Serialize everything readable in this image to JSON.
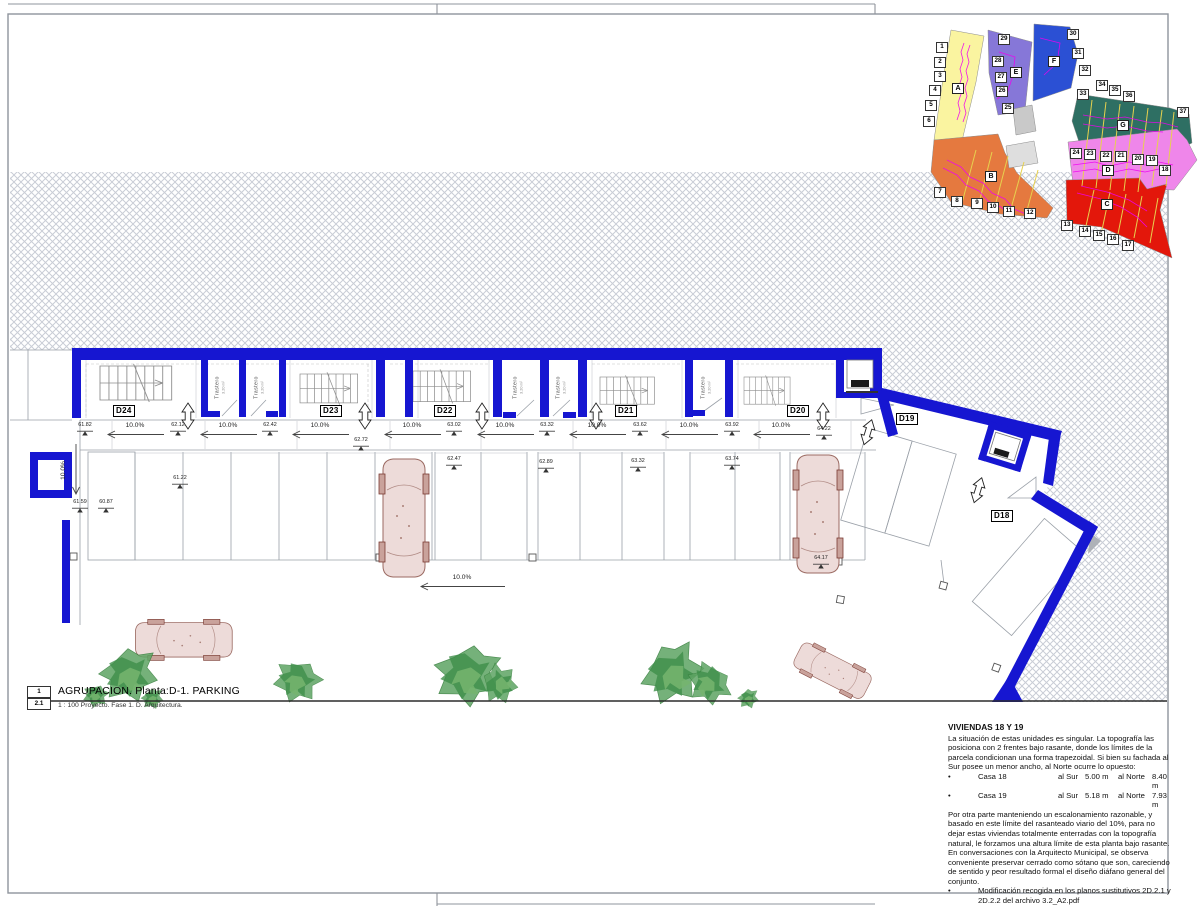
{
  "colors": {
    "wall_blue": "#1616d1",
    "hatch_gray": "#c9cdd6"
  },
  "title_block": {
    "sheet_no": "1",
    "detail_no": "2.1",
    "title": "AGRUPACION. Planta:D-1. PARKING",
    "scale_line": "1 : 100 Proyecto. Fase 1. D. Arquitectura."
  },
  "notes": {
    "title": "VIVIENDAS 18 Y 19",
    "bullet_char": "•",
    "para1": "La situación de estas unidades es singular. La topografía las posiciona con 2 frentes bajo rasante, donde los límites de la parcela condicionan una forma trapezoidal. Si bien su fachada al Sur posee un menor ancho, al Norte ocurre lo opuesto:",
    "bullets": [
      {
        "name": "Casa 18",
        "sur_label": "al Sur",
        "sur": "5.00 m",
        "norte_label": "al Norte",
        "norte": "8.40 m"
      },
      {
        "name": "Casa 19",
        "sur_label": "al Sur",
        "sur": "5.18 m",
        "norte_label": "al Norte",
        "norte": "7.93 m"
      }
    ],
    "para2": "Por otra parte manteniendo un escalonamiento razonable, y basado en este límite del rasanteado viario del 10%, para no dejar estas viviendas totalmente enterradas con la topografía natural, le forzamos una altura límite de esta planta bajo rasante. En conversaciones con la Arquitecto Municipal, se observa conveniente preservar cerrado como sótano que son, careciendo de sentido y peor resultado formal el diseño diáfano general del conjunto.",
    "bullet2_line1": "Modificación recogida en los planos sustitutivos 2D.2.1 y",
    "bullet2_line2": "2D.2.2 del archivo 3.2_A2.pdf"
  },
  "plan": {
    "slope_text": "10.0%",
    "trastero_label": "Trastero",
    "trastero_area": "3.20 m²",
    "units": [
      {
        "id": "D24",
        "x": 126,
        "y": 412
      },
      {
        "id": "D23",
        "x": 333,
        "y": 412
      },
      {
        "id": "D22",
        "x": 447,
        "y": 412
      },
      {
        "id": "D21",
        "x": 628,
        "y": 412
      },
      {
        "id": "D20",
        "x": 800,
        "y": 412
      },
      {
        "id": "D19",
        "x": 909,
        "y": 420
      },
      {
        "id": "D18",
        "x": 1004,
        "y": 517
      }
    ],
    "aisle_elevations": [
      {
        "v": "61.82",
        "x": 88,
        "y": 429
      },
      {
        "v": "62.12",
        "x": 181,
        "y": 429
      },
      {
        "v": "62.42",
        "x": 273,
        "y": 429
      },
      {
        "v": "62.72",
        "x": 364,
        "y": 444
      },
      {
        "v": "63.02",
        "x": 457,
        "y": 429
      },
      {
        "v": "63.32",
        "x": 550,
        "y": 429
      },
      {
        "v": "63.62",
        "x": 643,
        "y": 429
      },
      {
        "v": "63.92",
        "x": 735,
        "y": 429
      },
      {
        "v": "64.22",
        "x": 827,
        "y": 433
      }
    ],
    "bay_elevations": [
      {
        "v": "61.59",
        "x": 83,
        "y": 506
      },
      {
        "v": "60.87",
        "x": 109,
        "y": 506
      },
      {
        "v": "61.22",
        "x": 183,
        "y": 482
      },
      {
        "v": "62.47",
        "x": 457,
        "y": 463
      },
      {
        "v": "62.89",
        "x": 549,
        "y": 466
      },
      {
        "v": "63.32",
        "x": 641,
        "y": 465
      },
      {
        "v": "63.74",
        "x": 735,
        "y": 463
      },
      {
        "v": "64.17",
        "x": 824,
        "y": 562
      }
    ],
    "slope_arrows": [
      {
        "x": 135,
        "y": 426,
        "dir": "left",
        "len": 58
      },
      {
        "x": 228,
        "y": 426,
        "dir": "left",
        "len": 58
      },
      {
        "x": 320,
        "y": 426,
        "dir": "left",
        "len": 58
      },
      {
        "x": 412,
        "y": 426,
        "dir": "left",
        "len": 58
      },
      {
        "x": 505,
        "y": 426,
        "dir": "left",
        "len": 58
      },
      {
        "x": 597,
        "y": 426,
        "dir": "left",
        "len": 58
      },
      {
        "x": 689,
        "y": 426,
        "dir": "left",
        "len": 58
      },
      {
        "x": 781,
        "y": 426,
        "dir": "left",
        "len": 58
      },
      {
        "x": 462,
        "y": 578,
        "dir": "left",
        "len": 86
      },
      {
        "x": 72,
        "y": 470,
        "dir": "down",
        "len": 52
      }
    ],
    "trasteros": [
      {
        "x": 222,
        "y": 381
      },
      {
        "x": 261,
        "y": 381
      },
      {
        "x": 520,
        "y": 381
      },
      {
        "x": 563,
        "y": 381
      },
      {
        "x": 708,
        "y": 381
      }
    ]
  },
  "keyplan": {
    "zones": [
      {
        "id": "A",
        "color": "#faf4a0"
      },
      {
        "id": "B",
        "color": "#e5793f"
      },
      {
        "id": "C",
        "color": "#e3170b"
      },
      {
        "id": "D",
        "color": "#ef86ea"
      },
      {
        "id": "E",
        "color": "#8677d8"
      },
      {
        "id": "F",
        "color": "#2b50d4"
      },
      {
        "id": "G",
        "color": "#2e6f63"
      }
    ],
    "letters": [
      {
        "n": "A",
        "x": 957,
        "y": 88
      },
      {
        "n": "B",
        "x": 990,
        "y": 176
      },
      {
        "n": "C",
        "x": 1106,
        "y": 204
      },
      {
        "n": "D",
        "x": 1107,
        "y": 170
      },
      {
        "n": "E",
        "x": 1015,
        "y": 72
      },
      {
        "n": "F",
        "x": 1053,
        "y": 61
      },
      {
        "n": "G",
        "x": 1122,
        "y": 125
      }
    ],
    "markers": [
      {
        "n": "1",
        "x": 942,
        "y": 47
      },
      {
        "n": "2",
        "x": 940,
        "y": 62
      },
      {
        "n": "3",
        "x": 940,
        "y": 76
      },
      {
        "n": "4",
        "x": 935,
        "y": 90
      },
      {
        "n": "5",
        "x": 931,
        "y": 105
      },
      {
        "n": "6",
        "x": 929,
        "y": 121
      },
      {
        "n": "7",
        "x": 940,
        "y": 192
      },
      {
        "n": "8",
        "x": 957,
        "y": 201
      },
      {
        "n": "9",
        "x": 977,
        "y": 203
      },
      {
        "n": "10",
        "x": 993,
        "y": 207
      },
      {
        "n": "11",
        "x": 1009,
        "y": 211
      },
      {
        "n": "12",
        "x": 1030,
        "y": 213
      },
      {
        "n": "13",
        "x": 1067,
        "y": 225
      },
      {
        "n": "14",
        "x": 1085,
        "y": 231
      },
      {
        "n": "15",
        "x": 1099,
        "y": 235
      },
      {
        "n": "16",
        "x": 1113,
        "y": 239
      },
      {
        "n": "17",
        "x": 1128,
        "y": 245
      },
      {
        "n": "18",
        "x": 1165,
        "y": 170
      },
      {
        "n": "19",
        "x": 1152,
        "y": 160
      },
      {
        "n": "20",
        "x": 1138,
        "y": 159
      },
      {
        "n": "21",
        "x": 1121,
        "y": 156
      },
      {
        "n": "22",
        "x": 1106,
        "y": 156
      },
      {
        "n": "23",
        "x": 1090,
        "y": 154
      },
      {
        "n": "24",
        "x": 1076,
        "y": 153
      },
      {
        "n": "25",
        "x": 1008,
        "y": 108
      },
      {
        "n": "26",
        "x": 1002,
        "y": 91
      },
      {
        "n": "27",
        "x": 1001,
        "y": 77
      },
      {
        "n": "28",
        "x": 998,
        "y": 61
      },
      {
        "n": "29",
        "x": 1004,
        "y": 39
      },
      {
        "n": "30",
        "x": 1073,
        "y": 34
      },
      {
        "n": "31",
        "x": 1078,
        "y": 53
      },
      {
        "n": "32",
        "x": 1085,
        "y": 70
      },
      {
        "n": "33",
        "x": 1083,
        "y": 94
      },
      {
        "n": "34",
        "x": 1102,
        "y": 85
      },
      {
        "n": "35",
        "x": 1115,
        "y": 90
      },
      {
        "n": "36",
        "x": 1129,
        "y": 96
      },
      {
        "n": "37",
        "x": 1183,
        "y": 112
      }
    ]
  }
}
